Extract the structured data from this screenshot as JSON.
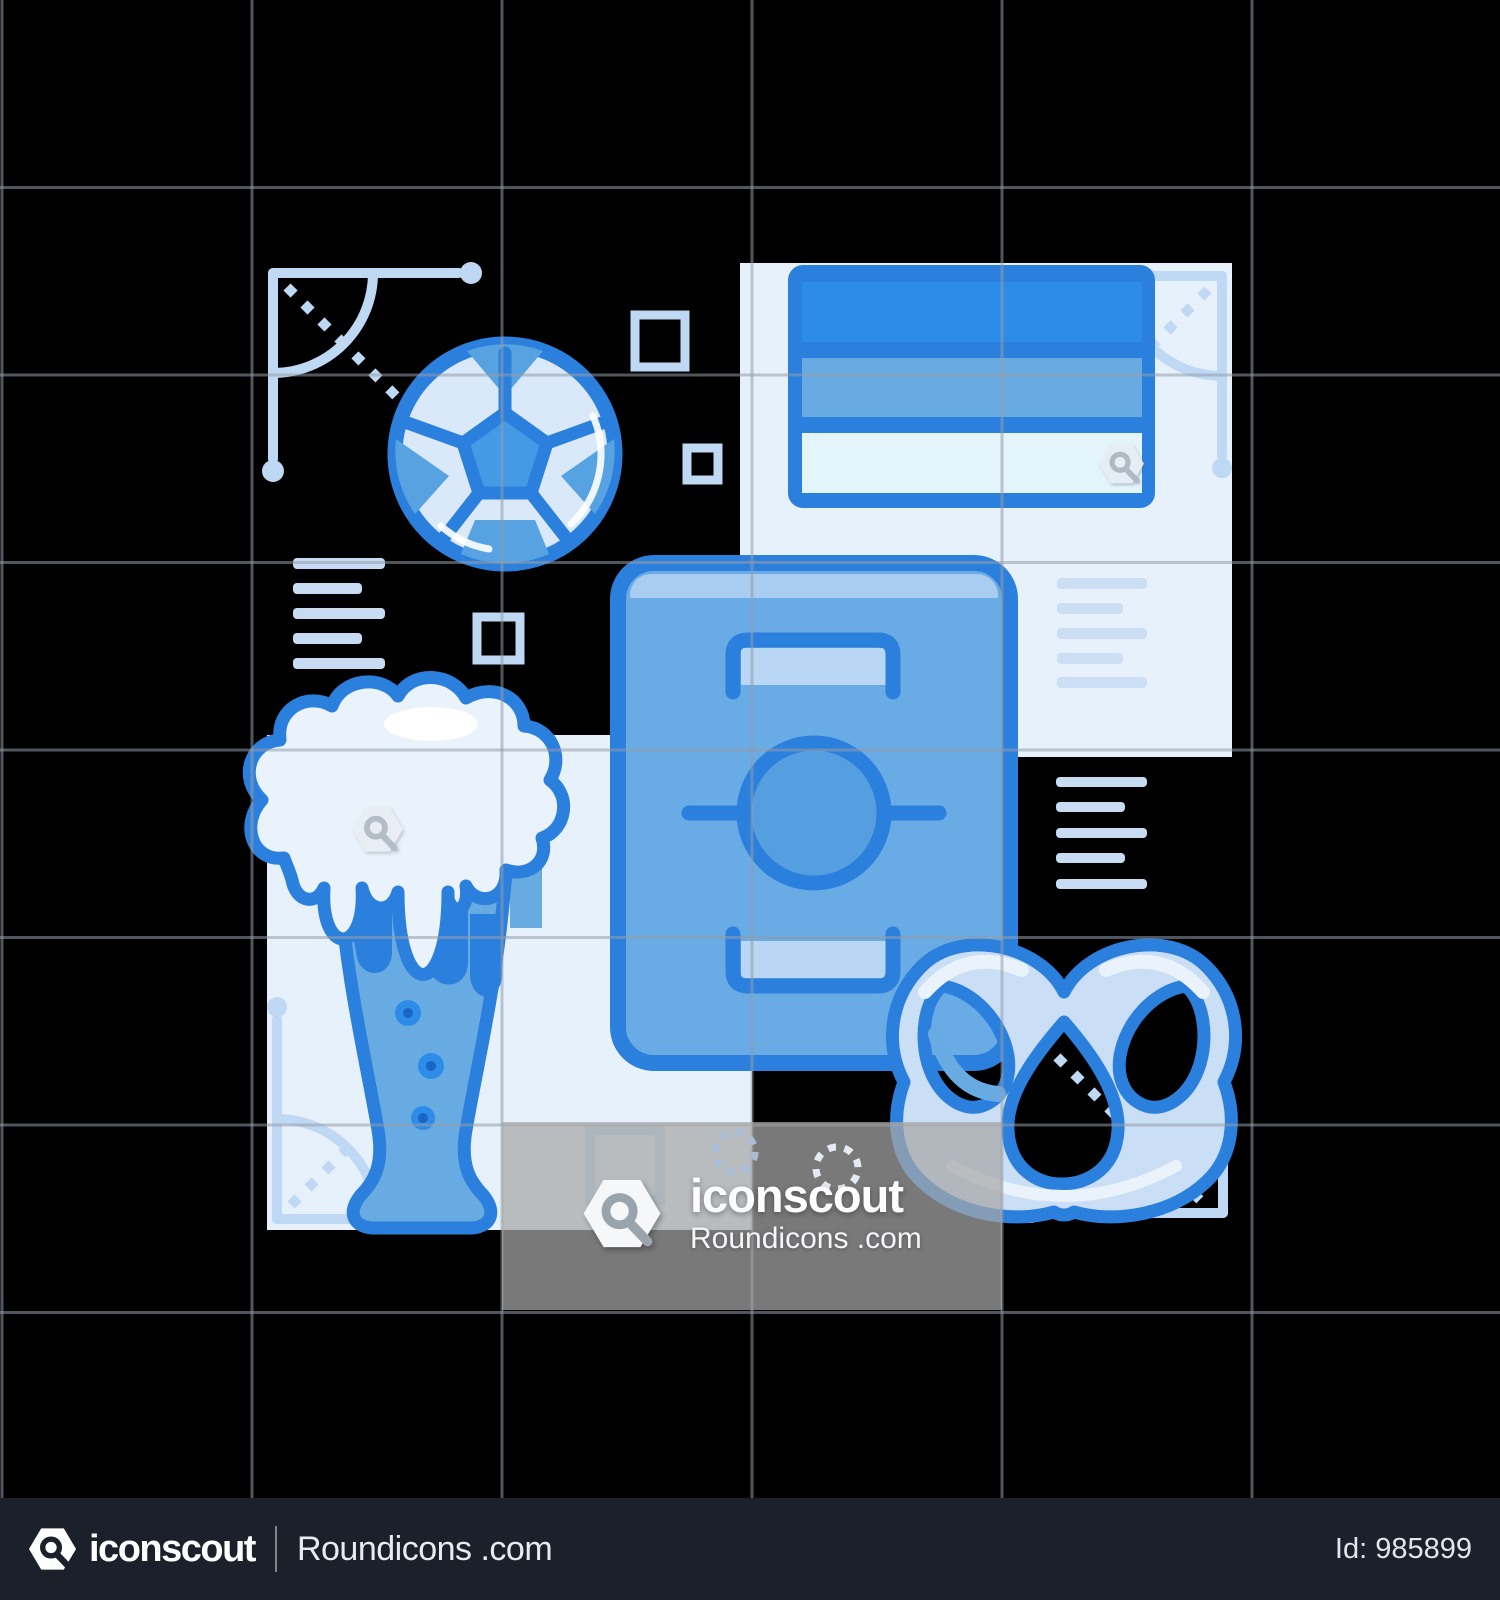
{
  "watermark": {
    "brand": "iconscout",
    "source": "Roundicons .com"
  },
  "footer": {
    "brand": "iconscout",
    "source": "Roundicons .com",
    "id_label": "Id: 985899"
  },
  "icons": {
    "main": [
      "soccer-ball-icon",
      "scoreboard-icon",
      "football-field-icon",
      "beer-glass-icon",
      "pretzel-icon"
    ],
    "decorative": [
      "corner-ruler-icon",
      "dotted-diagonal-icon",
      "hollow-square-icon",
      "text-lines-icon",
      "spinner-circle-icon",
      "hexagon-magnifier-watermark-icon"
    ]
  },
  "palette": {
    "bg": "#000000",
    "accent": "#2b7fdd",
    "bright": "#2e8ce9",
    "mid": "#68abe3",
    "soft": "#a9cdf1",
    "pale": "#cadff5",
    "panel": "#e7f1fb",
    "foam": "#eaf3fc",
    "deco": "#bfd9f4",
    "lines": "#c7dbf3",
    "field": "#68abe5",
    "circle": "#559fe0",
    "goal": "#b9d7f4",
    "pent": "#459ae6",
    "wedge": "#57a3e2",
    "bubble": "#1a64c4",
    "grid": "rgba(148,156,168,0.55)",
    "overlay": "rgba(168,168,168,0.72)",
    "bar": "#1b202b"
  }
}
